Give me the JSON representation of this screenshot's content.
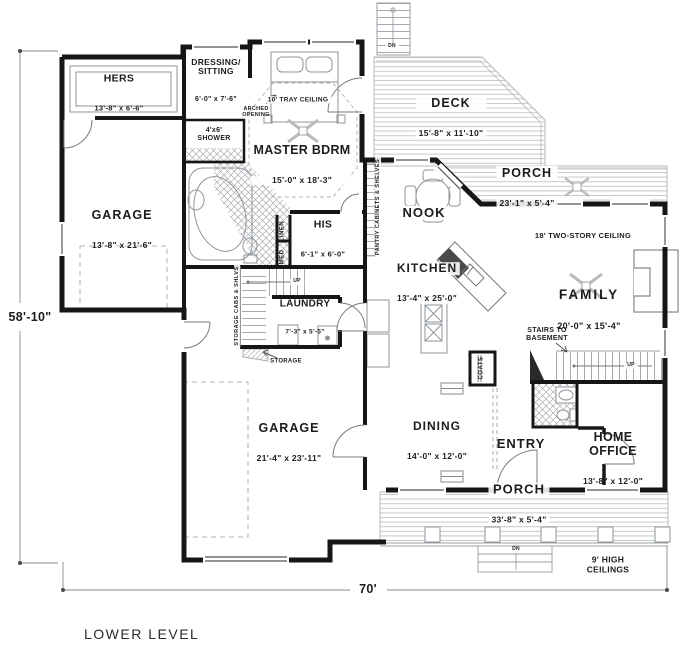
{
  "colors": {
    "wall": "#161616",
    "thin_line": "#8f959b",
    "text": "#1c1c1c",
    "hatch": "#a8adb2"
  },
  "plan": {
    "footer_title": "LOWER LEVEL",
    "overall_depth": "58'-10\"",
    "overall_width": "70'",
    "rooms": {
      "hers": {
        "name": "HERS",
        "size": "13'-8\" x 6'-6\""
      },
      "dressing": {
        "name": "DRESSING/\nSITTING",
        "size": "6'-0\" x 7'-6\""
      },
      "master": {
        "name": "MASTER BDRM",
        "size": "15'-0\" x 18'-3\""
      },
      "deck": {
        "name": "DECK",
        "size": "15'-8\" x 11'-10\""
      },
      "rear_porch": {
        "name": "PORCH",
        "size": "23'-1\" x 5'-4\""
      },
      "nook": {
        "name": "NOOK",
        "size": ""
      },
      "garage_upper": {
        "name": "GARAGE",
        "size": "13'-8\" x 21'-6\""
      },
      "his": {
        "name": "HIS",
        "size": "6'-1\" x 6'-0\""
      },
      "kitchen": {
        "name": "KITCHEN",
        "size": "13'-4\" x 25'-0\""
      },
      "family": {
        "name": "FAMILY",
        "size": "20'-0\" x 15'-4\""
      },
      "laundry": {
        "name": "LAUNDRY",
        "size": "7'-3\" x 5'-5\""
      },
      "dining": {
        "name": "DINING",
        "size": "14'-0\" x 12'-0\""
      },
      "entry": {
        "name": "ENTRY",
        "size": ""
      },
      "home_office": {
        "name": "HOME OFFICE",
        "size": "13'-8\" x 12'-0\""
      },
      "garage_lower": {
        "name": "GARAGE",
        "size": "21'-4\" x 23'-11\""
      },
      "front_porch": {
        "name": "PORCH",
        "size": "33'-8\" x 5'-4\""
      }
    },
    "notes": {
      "tray_ceiling": "10' TRAY CEILING",
      "arched_opening": "ARCHED\nOPENING",
      "shower": "4'x6'\nSHOWER",
      "linen": "LINEN",
      "med": "MED",
      "pantry": "PANTRY CABINETS & SHELVES",
      "storage_cabs": "STORAGE CABS & SHLVS",
      "storage": "STORAGE",
      "coats": "COATS",
      "stairs_basement": "STAIRS TO\nBASEMENT",
      "two_story": "18' TWO-STORY CEILING",
      "high_ceilings": "9' HIGH\nCEILINGS",
      "up": "UP",
      "dn": "DN"
    }
  }
}
